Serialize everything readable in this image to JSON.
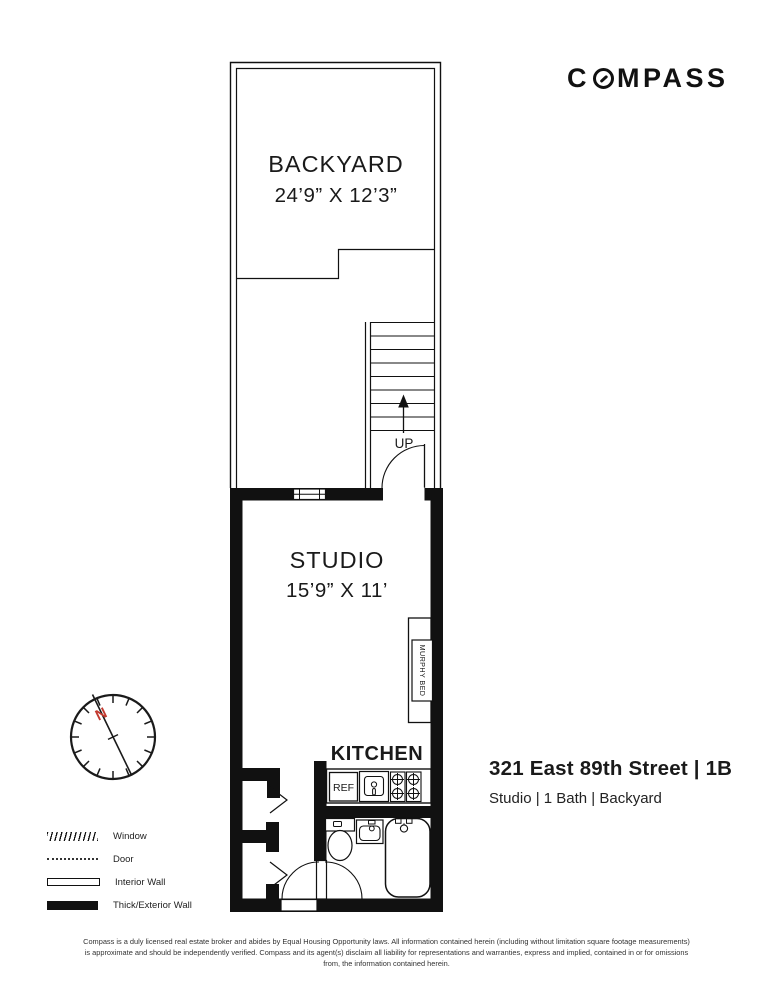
{
  "brand": {
    "logo_left": "C",
    "logo_right": "MPASS"
  },
  "listing": {
    "title": "321 East 89th Street | 1B",
    "subtitle": "Studio | 1 Bath | Backyard"
  },
  "floorplan": {
    "backyard": {
      "label": "BACKYARD",
      "dimensions": "24’9” X 12’3”"
    },
    "stairs": {
      "up_label": "UP"
    },
    "studio": {
      "label": "STUDIO",
      "dimensions": "15’9” X 11’"
    },
    "murphy_bed_label": "MURPHY BED",
    "kitchen": {
      "label": "KITCHEN",
      "fridge_label": "REF"
    }
  },
  "compass_rose": {
    "north_label": "N",
    "north_color": "#c23a30"
  },
  "legend": {
    "items": [
      {
        "label": "Window"
      },
      {
        "label": "Door"
      },
      {
        "label": "Interior Wall"
      },
      {
        "label": "Thick/Exterior Wall"
      }
    ]
  },
  "disclaimer": {
    "text": "Compass is a duly licensed real estate broker and abides by Equal Housing Opportunity laws. All information contained herein (including without limitation square footage measurements) is approximate and should be independently verified. Compass and its agent(s) disclaim all liability for representations and warranties, express and implied, contained in or for omissions from, the information contained herein."
  }
}
